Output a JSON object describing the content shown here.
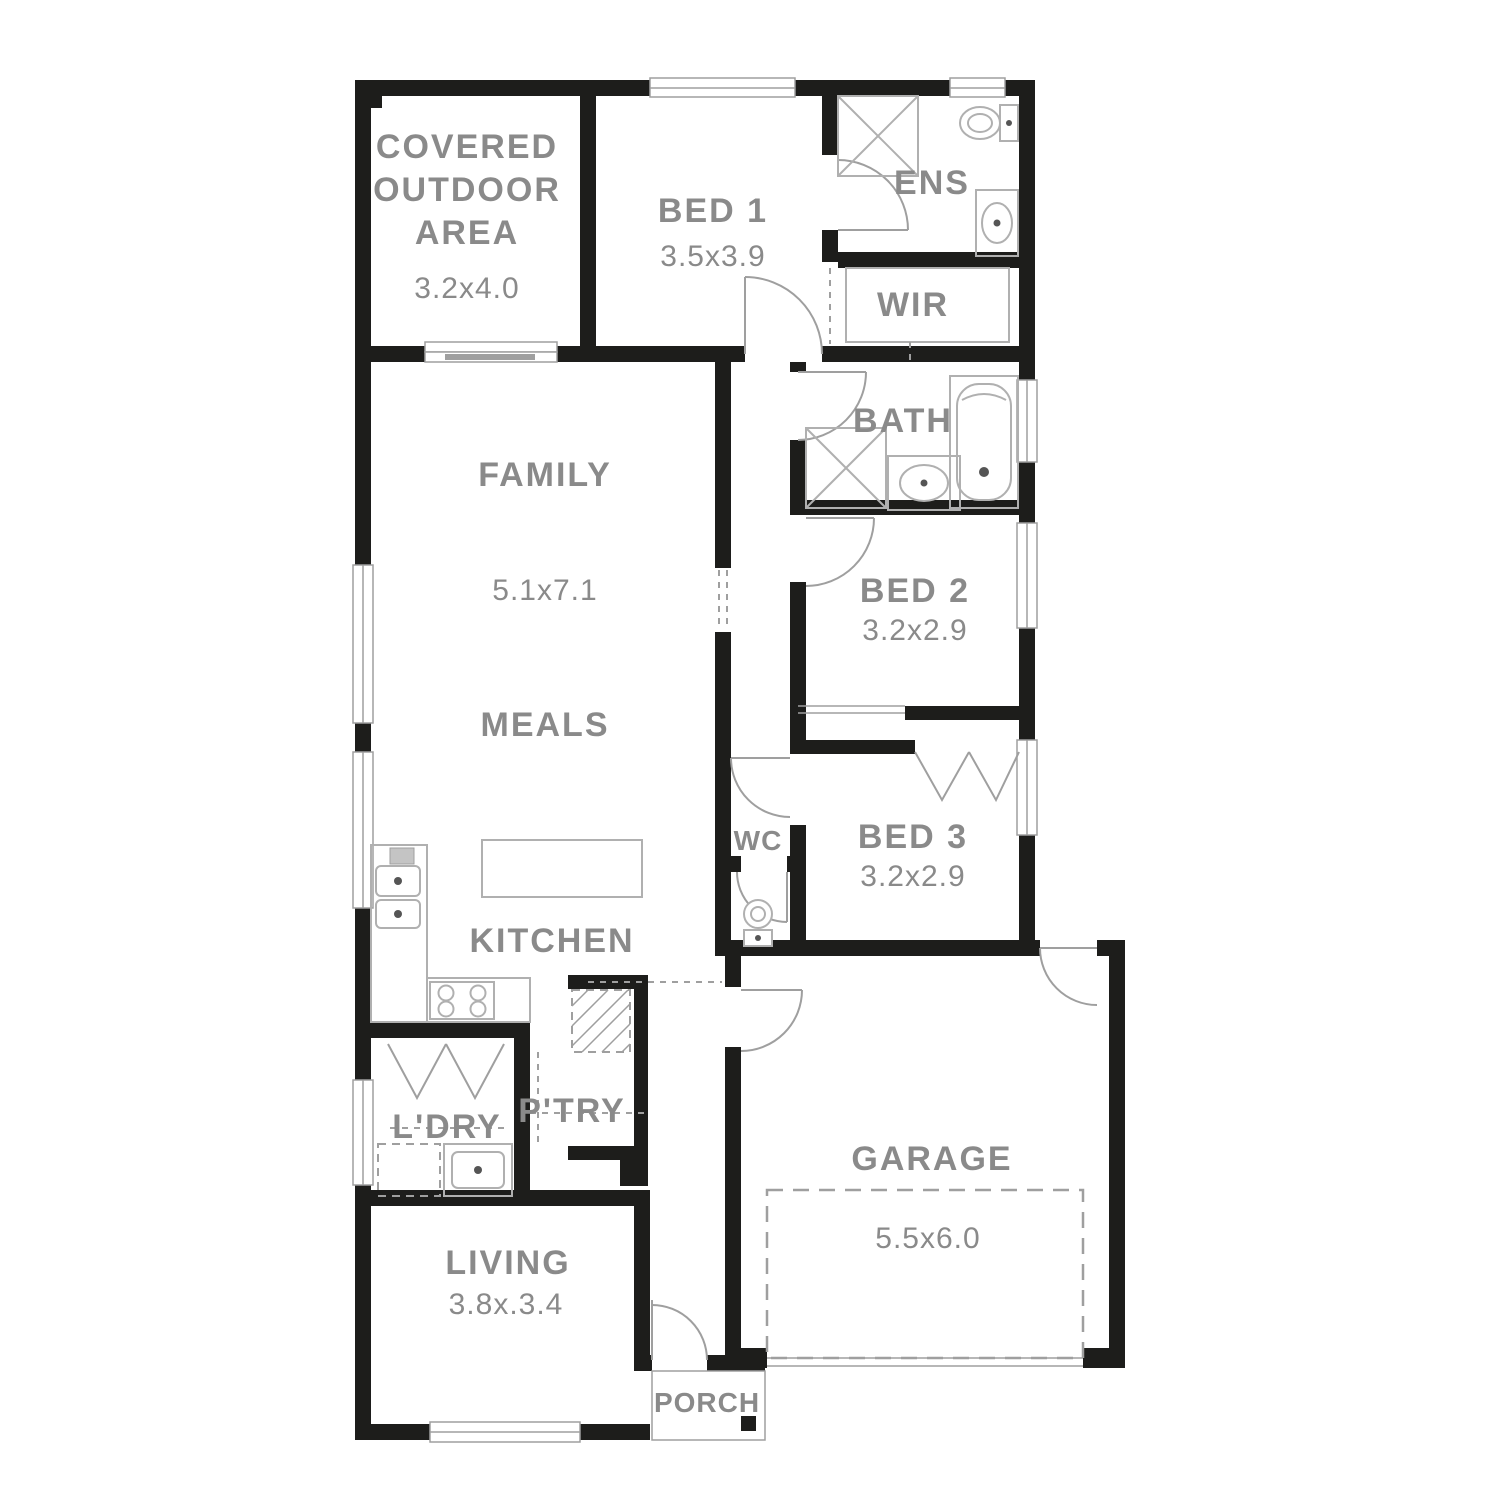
{
  "plan": {
    "type": "residential-floor-plan",
    "colors": {
      "wall": "#1d1d1b",
      "line": "#9f9f9f",
      "fixture": "#b0b0b0",
      "text": "#8a8a8a",
      "background": "#ffffff"
    },
    "rooms": {
      "covered_outdoor": {
        "line1": "COVERED",
        "line2": "OUTDOOR",
        "line3": "AREA",
        "dims": "3.2x4.0"
      },
      "bed1": {
        "name": "BED 1",
        "dims": "3.5x3.9"
      },
      "ens": {
        "name": "ENS"
      },
      "wir": {
        "name": "WIR"
      },
      "family": {
        "name": "FAMILY",
        "dims": "5.1x7.1"
      },
      "meals": {
        "name": "MEALS"
      },
      "kitchen": {
        "name": "KITCHEN"
      },
      "bath": {
        "name": "BATH"
      },
      "bed2": {
        "name": "BED 2",
        "dims": "3.2x2.9"
      },
      "bed3": {
        "name": "BED 3",
        "dims": "3.2x2.9"
      },
      "wc": {
        "name": "WC"
      },
      "laundry": {
        "name": "L'DRY"
      },
      "pantry": {
        "name": "P'TRY"
      },
      "garage": {
        "name": "GARAGE",
        "dims": "5.5x6.0"
      },
      "living": {
        "name": "LIVING",
        "dims": "3.8x.3.4"
      },
      "porch": {
        "name": "PORCH"
      }
    },
    "fixtures": [
      "shower",
      "toilet",
      "vanity-basin",
      "bathtub",
      "wardrobe-shelving",
      "kitchen-sink",
      "cooktop",
      "island-bench",
      "laundry-trough",
      "appliance-space",
      "fridge-space-hatched"
    ]
  }
}
